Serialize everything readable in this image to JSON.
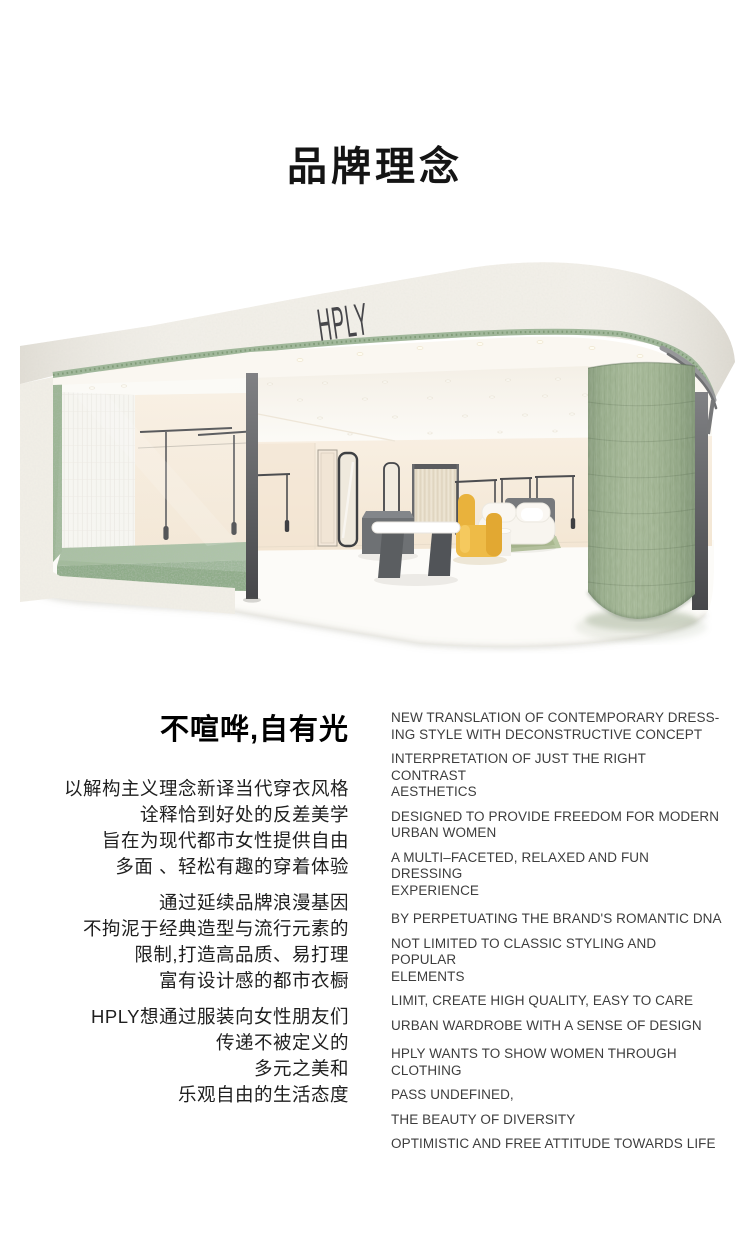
{
  "page": {
    "title": "品牌理念"
  },
  "store_render": {
    "brand_logo": "HPLY",
    "colors": {
      "terrazzo_green": "#a5bb9e",
      "column_green": "#a3b896",
      "chair_yellow": "#eab43e",
      "stucco_white": "#f2efe8",
      "interior_cream": "#f6ebdc"
    }
  },
  "philosophy": {
    "heading_zh": "不喧哗,自有光",
    "zh_blocks": [
      {
        "lines": [
          "以解构主义理念新译当代穿衣风格",
          "诠释恰到好处的反差美学",
          "旨在为现代都市女性提供自由",
          "多面 、轻松有趣的穿着体验"
        ]
      },
      {
        "lines": [
          "通过延续品牌浪漫基因",
          "不拘泥于经典造型与流行元素的",
          "限制,打造高品质、易打理",
          "富有设计感的都市衣橱"
        ]
      },
      {
        "lines": [
          "HPLY想通过服装向女性朋友们",
          "传递不被定义的",
          "多元之美和",
          "乐观自由的生活态度"
        ]
      }
    ],
    "en_blocks": [
      {
        "items": [
          "NEW TRANSLATION OF CONTEMPORARY DRESS-\nING STYLE WITH DECONSTRUCTIVE CONCEPT",
          "INTERPRETATION OF JUST THE RIGHT CONTRAST\nAESTHETICS",
          "DESIGNED TO PROVIDE FREEDOM FOR MODERN\nURBAN WOMEN",
          "A MULTI–FACETED, RELAXED AND FUN DRESSING\nEXPERIENCE"
        ]
      },
      {
        "items": [
          "BY PERPETUATING THE BRAND'S ROMANTIC DNA",
          "NOT LIMITED TO CLASSIC STYLING AND POPULAR\nELEMENTS",
          "LIMIT, CREATE HIGH QUALITY, EASY TO CARE",
          "URBAN WARDROBE WITH A SENSE OF DESIGN"
        ]
      },
      {
        "items": [
          "HPLY WANTS TO SHOW WOMEN THROUGH\nCLOTHING",
          "PASS UNDEFINED,",
          "THE BEAUTY OF DIVERSITY",
          "OPTIMISTIC AND FREE ATTITUDE TOWARDS LIFE"
        ]
      }
    ]
  }
}
